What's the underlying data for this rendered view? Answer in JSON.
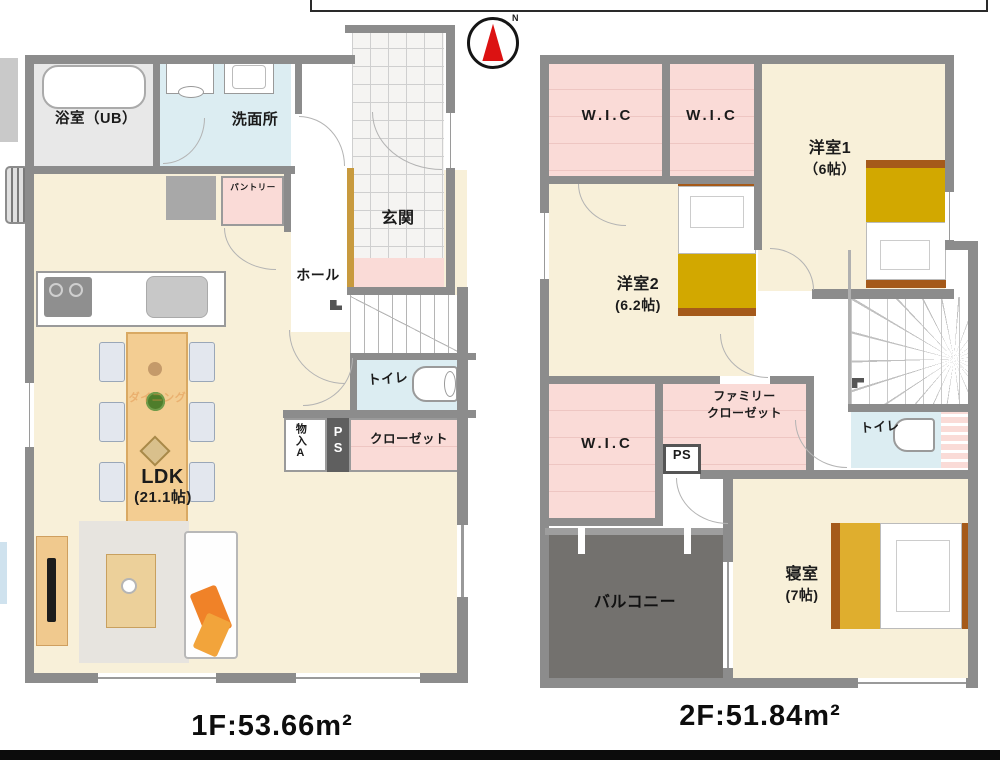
{
  "compass": {
    "north_label": "N"
  },
  "colors": {
    "wall": "#8c8c8c",
    "floor_cream": "#f8f0d9",
    "closet_pink": "#fadbd7",
    "wet_cyan": "#dcedf2",
    "balcony_gray": "#73716e",
    "bed_gold": "#d2a800",
    "bed_frame_brown": "#a55a1a",
    "compass_red": "#dc1212",
    "table_tan": "#f3cd92"
  },
  "floor1": {
    "area_label": "1F:53.66m²",
    "rooms": {
      "bath": "浴室（UB）",
      "washroom": "洗面所",
      "entrance": "玄関",
      "hall": "ホール",
      "pantry": "パントリー",
      "toilet": "トイレ",
      "storage": "物入A",
      "pipe_space": "PS",
      "closet": "クローゼット",
      "ldk": "LDK",
      "ldk_size": "(21.1帖)",
      "dining_watermark": "ダイニング"
    }
  },
  "floor2": {
    "area_label": "2F:51.84m²",
    "rooms": {
      "wic1": "W.I.C",
      "wic2": "W.I.C",
      "wic3": "W.I.C",
      "bedroom1": "洋室1",
      "bedroom1_size": "（6帖）",
      "bedroom2": "洋室2",
      "bedroom2_size": "(6.2帖)",
      "family_closet_line1": "ファミリー",
      "family_closet_line2": "クローゼット",
      "pipe_space": "PS",
      "toilet": "トイレ",
      "master": "寝室",
      "master_size": "(7帖)",
      "balcony": "バルコニー"
    }
  }
}
